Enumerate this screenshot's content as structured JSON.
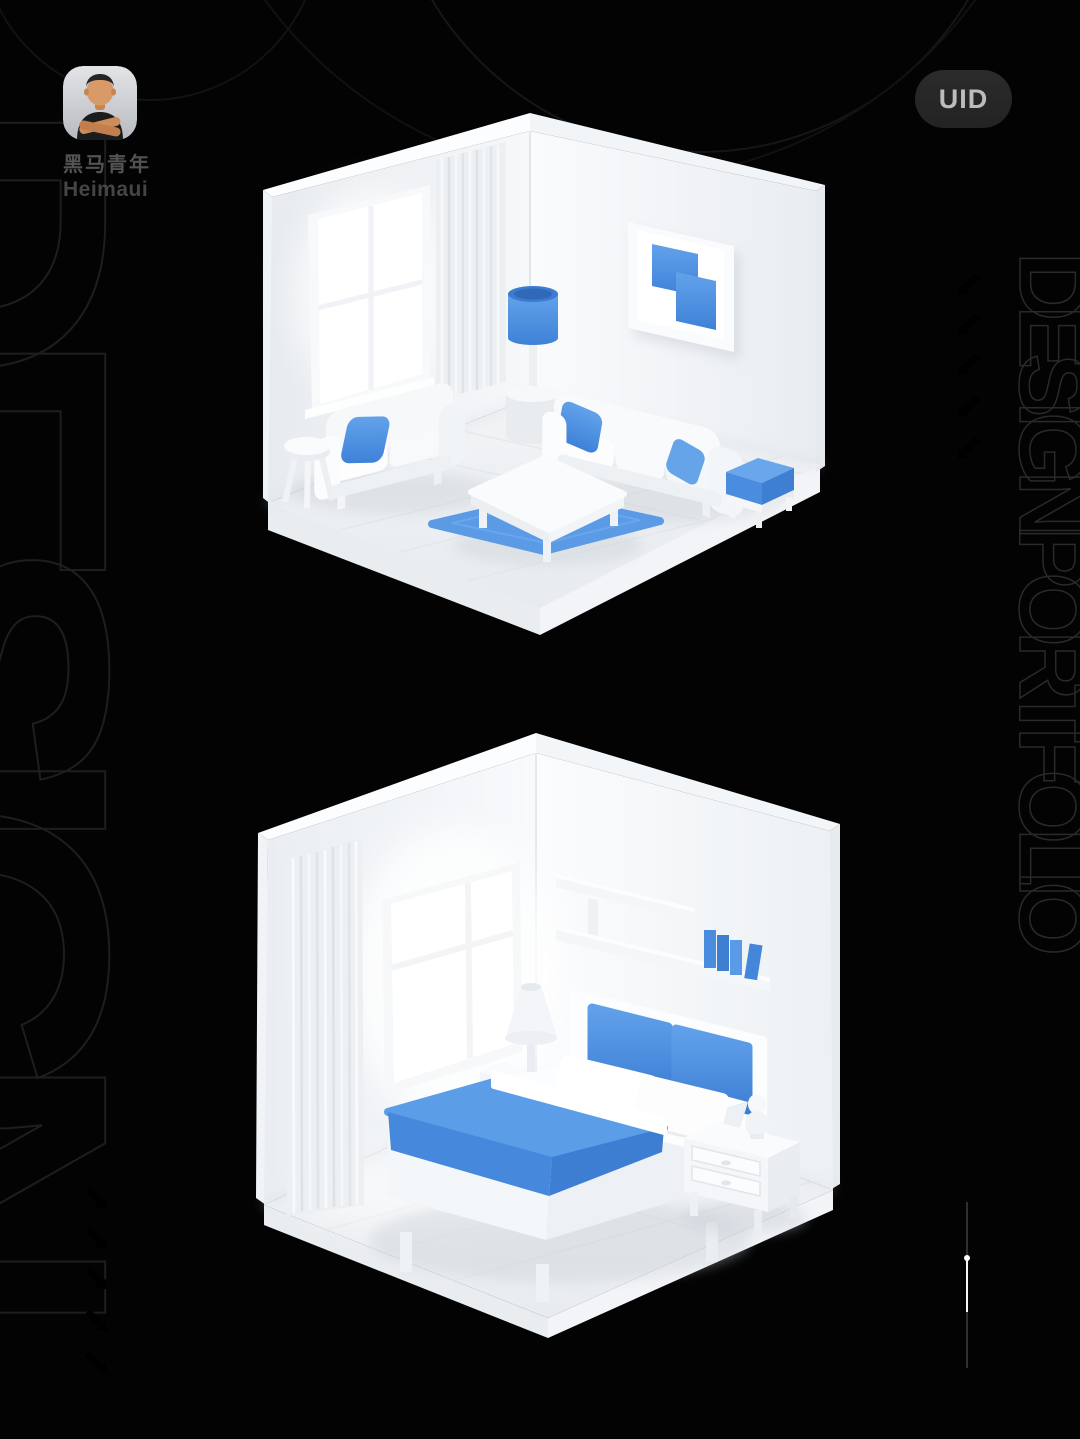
{
  "page": {
    "background": "#030303",
    "accent_blue": "#4a8ede",
    "accent_blue_light": "#5b9ee9",
    "accent_blue_dark": "#3672c8"
  },
  "profile": {
    "avatar_icon": "memoji-man-crossed-arms",
    "name_primary": "黑马青年",
    "name_secondary": "Heimaui"
  },
  "badge": {
    "label": "UID"
  },
  "decor": {
    "side_text_right": "DESIGNPORTFOLIO",
    "side_text_left": "DESIGN",
    "arrows_right": {
      "direction": "down-left",
      "count": 5,
      "outlined": 3,
      "filled": 2
    },
    "arrows_bottom_left": {
      "direction": "down-right",
      "count": 5,
      "outlined": 3,
      "filled": 2
    }
  },
  "illustrations": {
    "top": "isometric-living-room-white-blue",
    "bottom": "isometric-bedroom-white-blue"
  }
}
